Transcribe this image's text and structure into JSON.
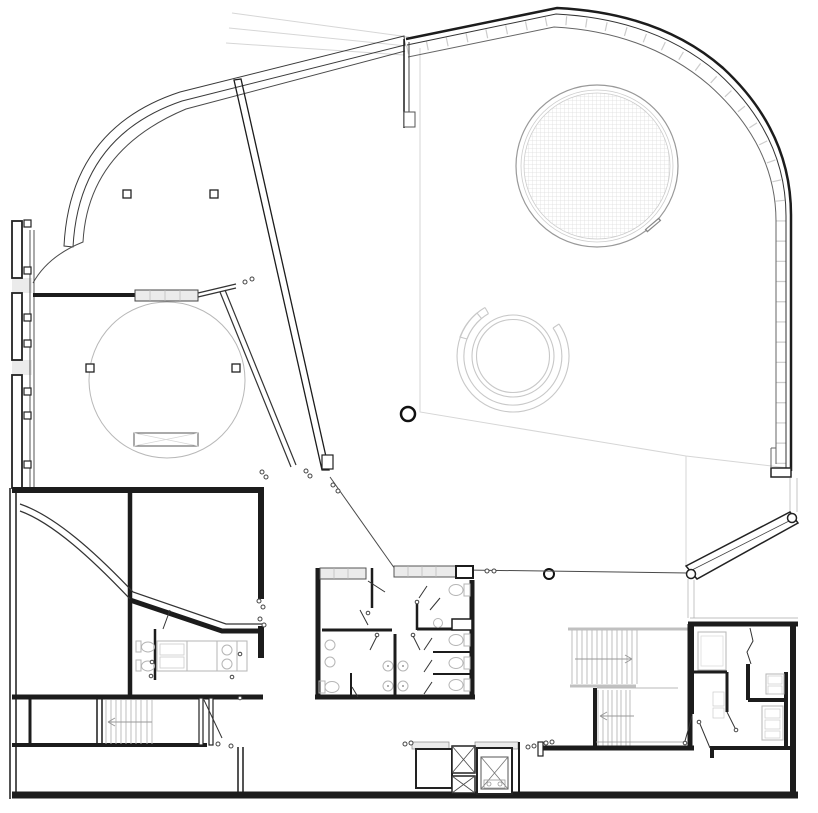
{
  "drawing": {
    "kind_label": "floor-plan-line-drawing",
    "features": [
      "exterior-curved-wall-northwest",
      "exterior-wall-northeast-rounded",
      "masonry-joint-tick-band",
      "exterior-wall-west-pier-segments",
      "exterior-wall-south",
      "site-contour-lines",
      "circular-skylight-with-grid-hatch",
      "spiral-ramp-arcs",
      "circular-room-west",
      "square-column-grid",
      "round-columns",
      "diagonal-partition-wall",
      "curved-ramp-wall-southwest",
      "central-restroom-block",
      "west-restroom-laundry-room",
      "wc-fixtures",
      "washbasins",
      "counter-appliances",
      "main-double-run-stair",
      "west-stair",
      "elevator-shafts",
      "entry-canopy-southeast",
      "bottom-right-service-rooms",
      "door-swing-symbols",
      "floor-edge-lines"
    ]
  },
  "colors": {
    "background": "#ffffff",
    "wall_dark": "#1c1c1c",
    "wall_medium": "#4a4a4a",
    "line_light": "#b8b8b8",
    "line_faint": "#d6d6d6",
    "band_fill": "#d9d9d9",
    "hatch_fill": "#ebebeb",
    "fixture": "#b5b5b5",
    "grid_hatch": "#dcdcdc"
  }
}
